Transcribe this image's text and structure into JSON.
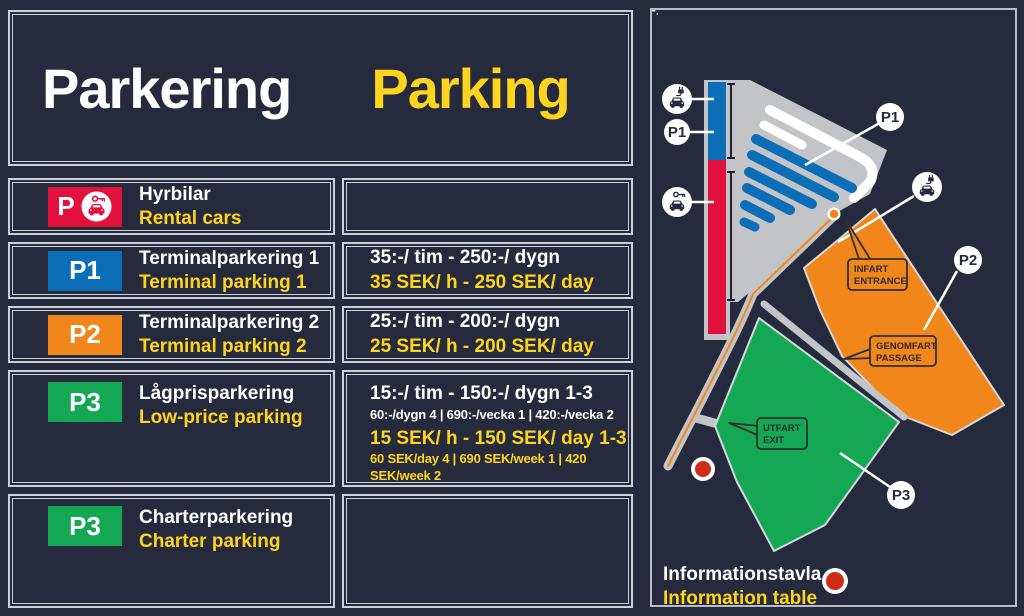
{
  "colors": {
    "background": "#252b3d",
    "accent_yellow": "#ffd41f",
    "rental_red": "#e2103c",
    "p1_blue": "#0d6eb8",
    "p2_orange": "#f1861b",
    "p3_green": "#14a855",
    "map_gray": "#c2c4c8",
    "info_dot_red": "#d02c1a",
    "border_light": "#ccd0da"
  },
  "header": {
    "title_sv": "Parkering",
    "title_en": "Parking"
  },
  "rows": [
    {
      "badge": "P",
      "badge_icon": "car-with-key-icon",
      "title_sv": "Hyrbilar",
      "title_en": "Rental cars"
    },
    {
      "badge": "P1",
      "title_sv": "Terminalparkering 1",
      "title_en": "Terminal parking 1",
      "price_sv": "35:-/ tim - 250:-/ dygn",
      "price_en": "35 SEK/ h - 250 SEK/ day"
    },
    {
      "badge": "P2",
      "title_sv": "Terminalparkering 2",
      "title_en": "Terminal parking 2",
      "price_sv": "25:-/ tim - 200:-/ dygn",
      "price_en": "25 SEK/ h - 200 SEK/ day"
    },
    {
      "badge": "P3",
      "title_sv": "Lågprisparkering",
      "title_en": "Low-price parking",
      "price_sv": "15:-/ tim - 150:-/ dygn 1-3",
      "price_sv_small": "60:-/dygn 4 | 690:-/vecka 1 | 420:-/vecka 2",
      "price_en": "15 SEK/ h - 150 SEK/ day 1-3",
      "price_en_small": "60 SEK/day 4 | 690 SEK/week 1 | 420 SEK/week 2"
    },
    {
      "badge": "P3",
      "title_sv": "Charterparkering",
      "title_en": "Charter parking"
    }
  ],
  "map": {
    "markers": {
      "p1_left": "P1",
      "p1_lot": "P1",
      "p2": "P2",
      "p3": "P3"
    },
    "icons": {
      "electric_car": "car-with-plug-icon",
      "rental_car": "car-with-key-icon",
      "info_point": "info-dot-icon"
    },
    "callouts": {
      "entrance": [
        "INFART",
        "ENTRANCE"
      ],
      "passage": [
        "GENOMFART",
        "PASSAGE"
      ],
      "exit": [
        "UTFART",
        "EXIT"
      ]
    },
    "legend": {
      "sv": "Informationstavla",
      "en": "Information table"
    }
  }
}
